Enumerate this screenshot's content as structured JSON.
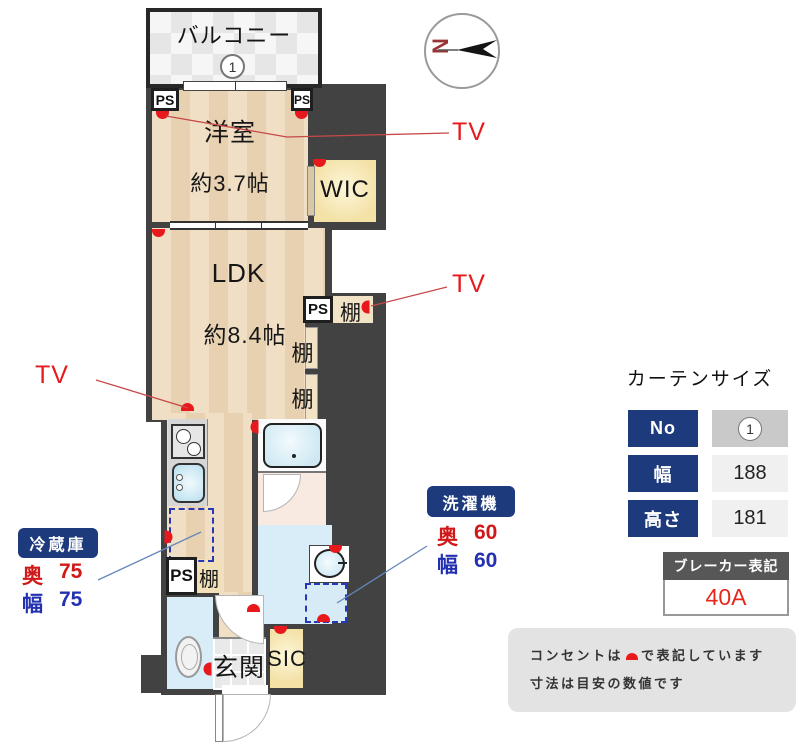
{
  "plan": {
    "balcony": {
      "label": "バルコニー",
      "marker": "1"
    },
    "rooms": {
      "yoshitsu": {
        "name": "洋室",
        "size": "約3.7帖"
      },
      "wic": "WIC",
      "ldk": {
        "name": "LDK",
        "size": "約8.4帖"
      },
      "genkan": "玄関",
      "sic": "SIC"
    },
    "labels": {
      "ps": "PS",
      "shelf": "棚",
      "tv": "TV"
    },
    "compass": "N"
  },
  "callouts": {
    "fridge": {
      "title": "冷蔵庫",
      "rows": [
        {
          "label": "奥",
          "value": "75"
        },
        {
          "label": "幅",
          "value": "75"
        }
      ]
    },
    "washer": {
      "title": "洗濯機",
      "rows": [
        {
          "label": "奥",
          "value": "60"
        },
        {
          "label": "幅",
          "value": "60"
        }
      ]
    }
  },
  "curtain": {
    "title": "カーテンサイズ",
    "rows": [
      {
        "label": "No",
        "value": "1"
      },
      {
        "label": "幅",
        "value": "188"
      },
      {
        "label": "高さ",
        "value": "181"
      }
    ]
  },
  "breaker": {
    "title": "ブレーカー表記",
    "value": "40A"
  },
  "notes": {
    "line1_before": "コンセントは",
    "line1_after": "で表記しています",
    "line2": "寸法は目安の数値です"
  },
  "colors": {
    "accent_navy": "#1d3a7d",
    "outlet_red": "#e8191c",
    "dim_red": "#d01818",
    "dim_blue": "#2330b0",
    "wall_dark": "#424242"
  }
}
